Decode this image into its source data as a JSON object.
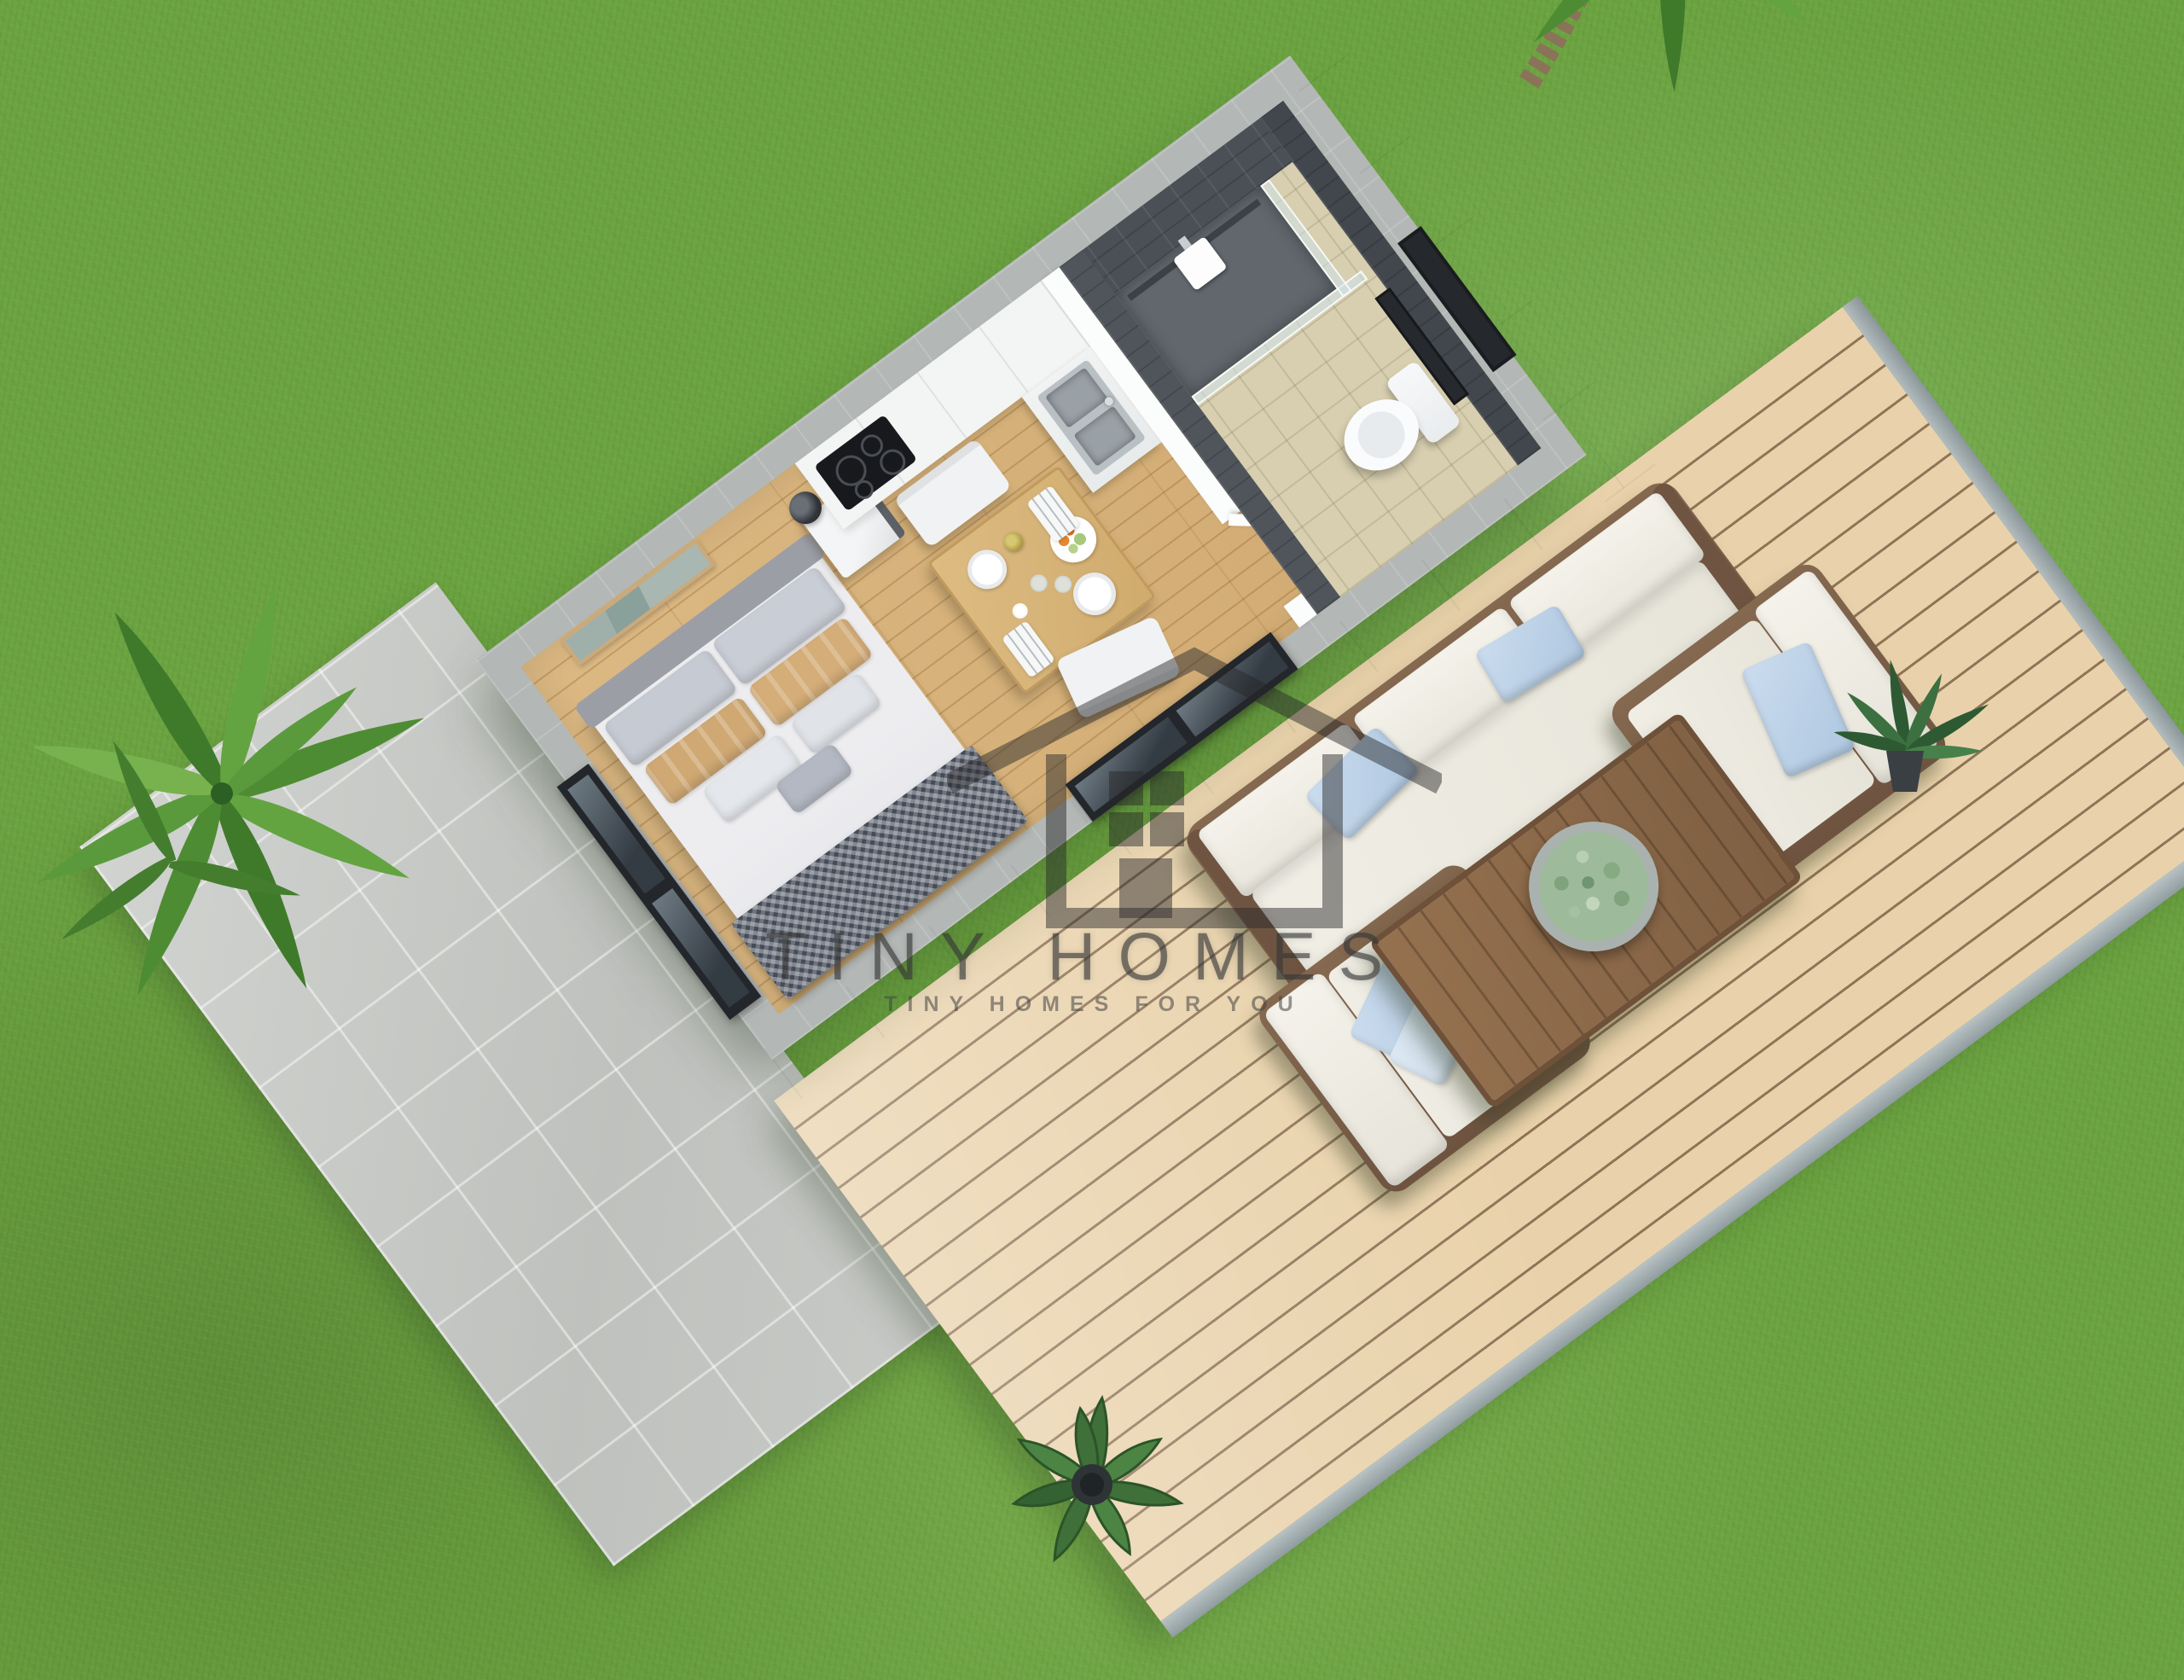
{
  "watermark": {
    "brand": "TINY HOMES",
    "tagline": "TINY HOMES FOR YOU",
    "icon": "house-outline-icon",
    "text_color": "#343434"
  },
  "colors": {
    "grass": "#6ca441",
    "patio_tile": "#c7c9c6",
    "deck_board": "#e9d2ab",
    "deck_gap": "#8f7457",
    "house_wall": "#fafbfb",
    "wall_tile_band": "#b3b7b5",
    "wood_floor": "#d7b17b",
    "bathroom_tile_dark": "#4b5057",
    "bathroom_floor": "#d8cfb0",
    "sofa_cushion": "#efede3",
    "pillow_blue": "#bcd3e8",
    "furniture_wood": "#7c6049",
    "palm_leaf": "#4e8c33"
  }
}
